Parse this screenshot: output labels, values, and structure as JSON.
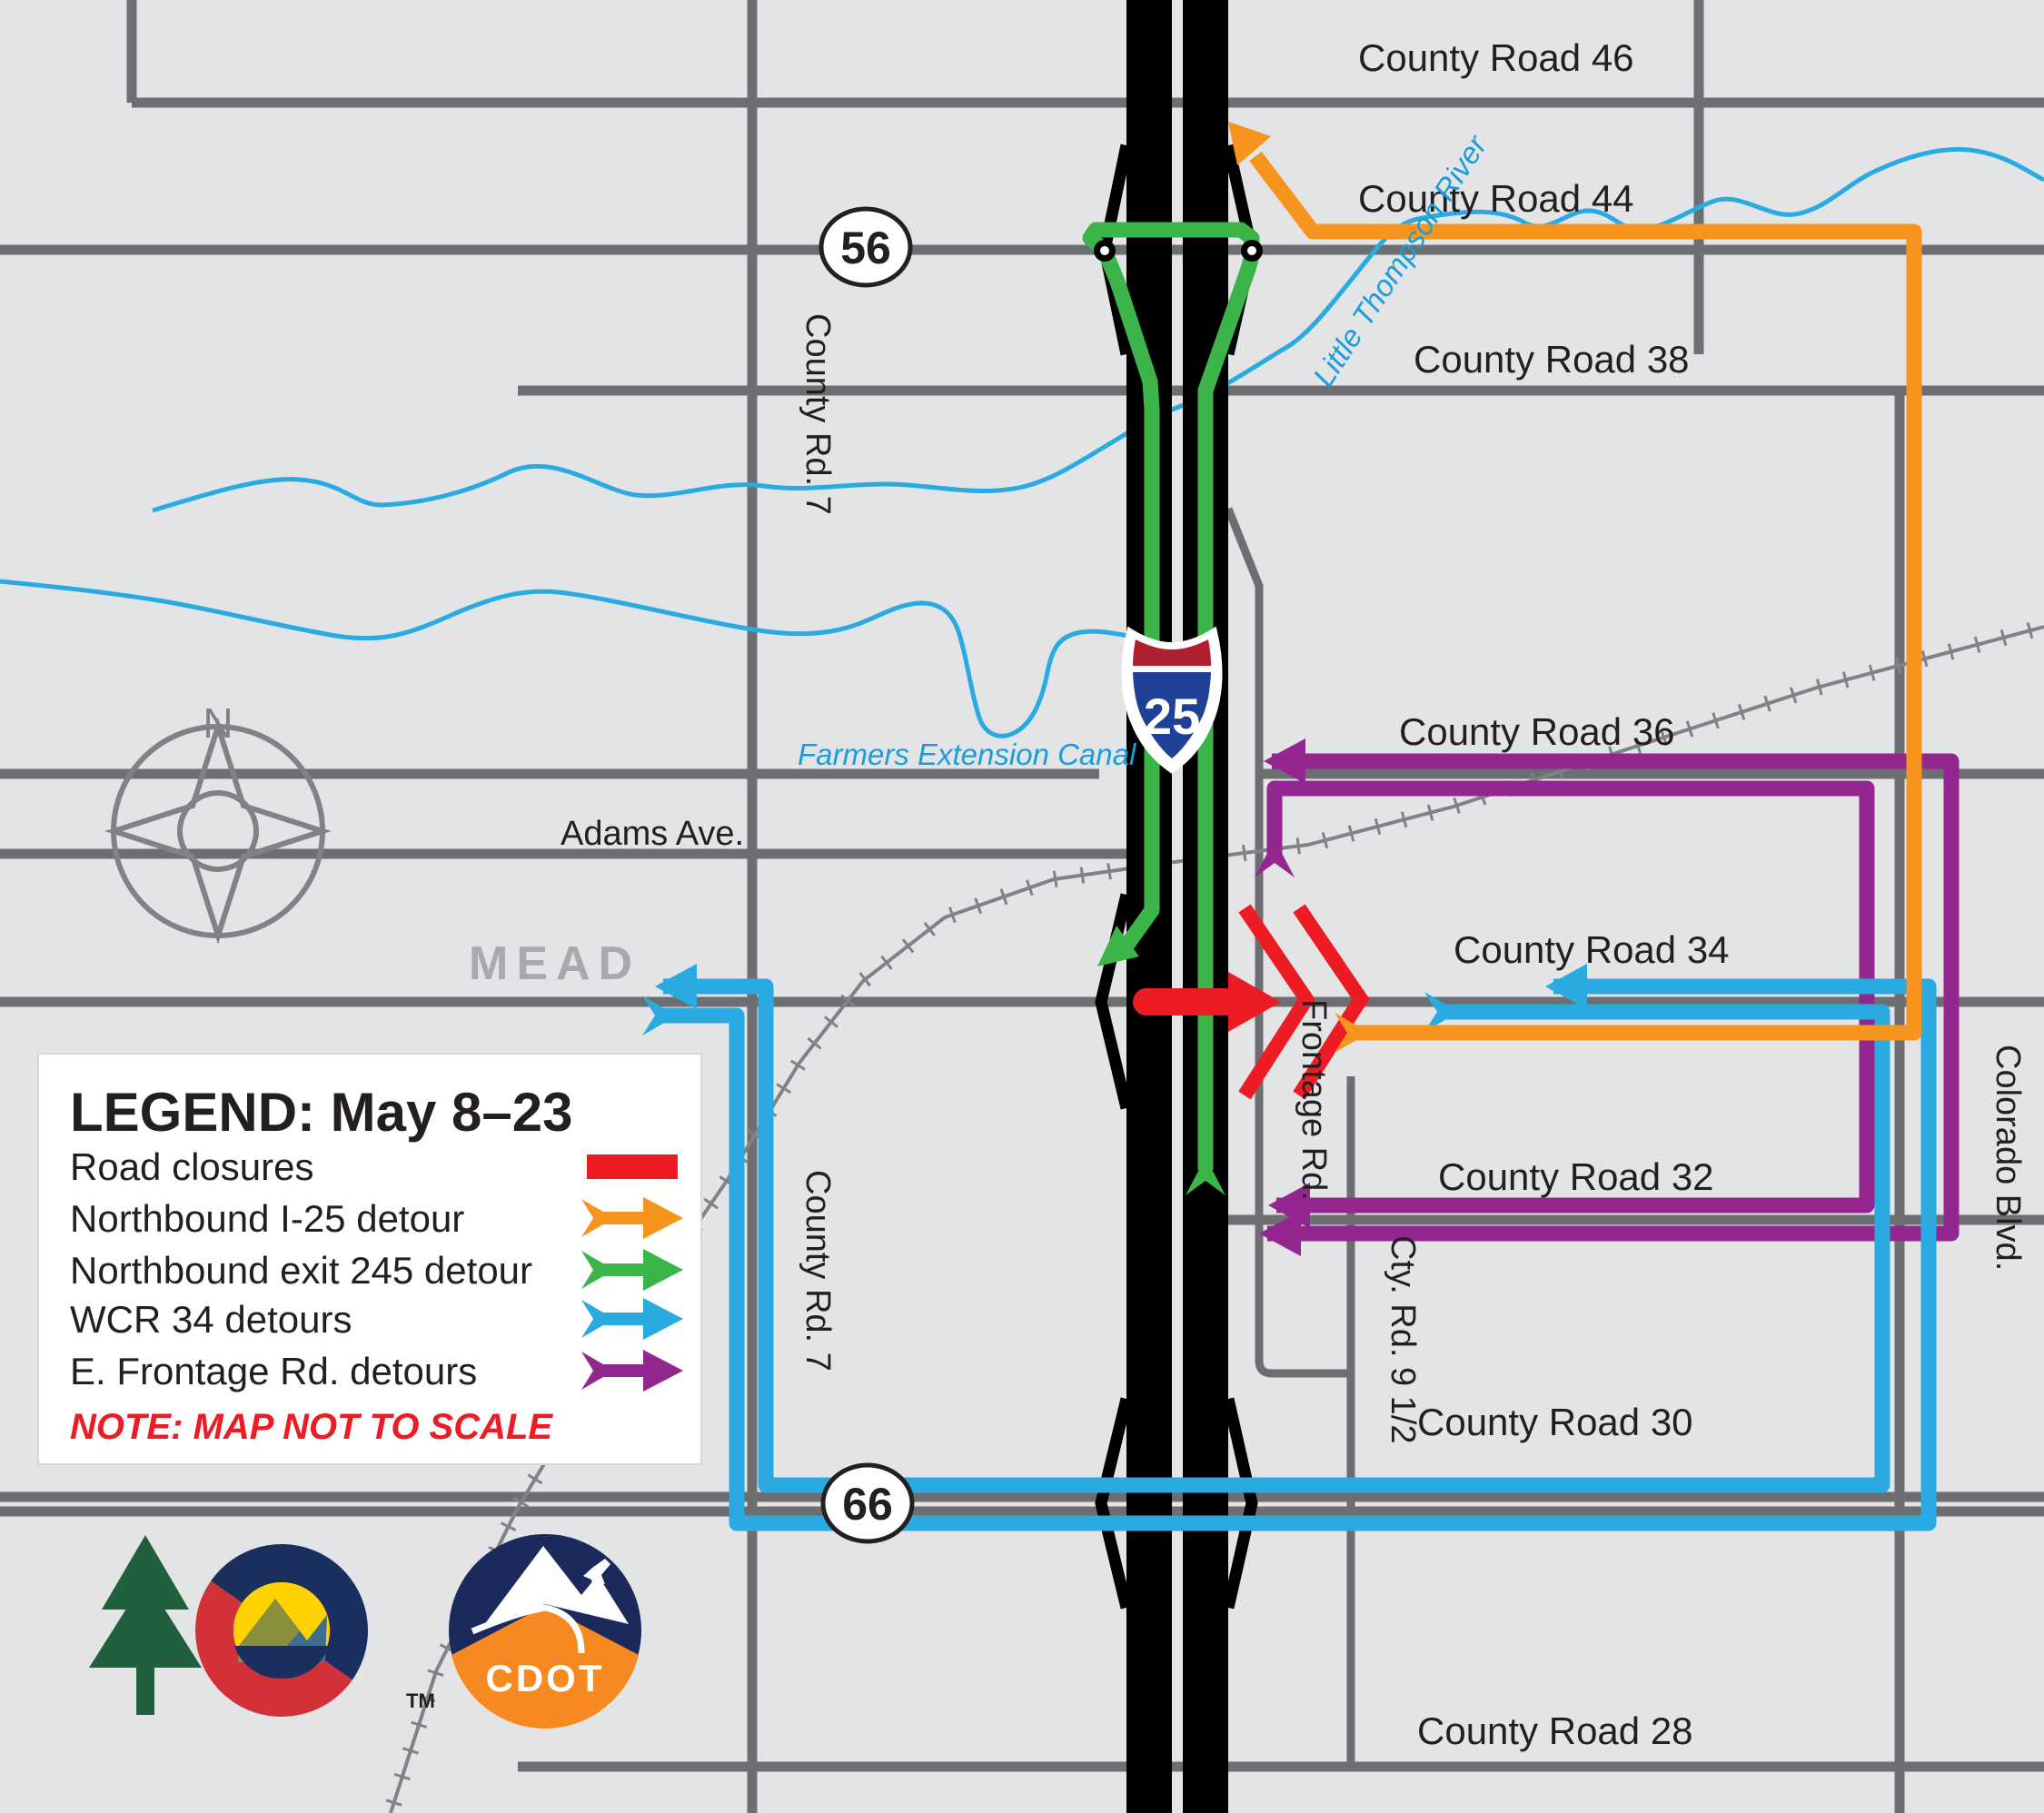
{
  "map": {
    "region_label": "MEAD",
    "compass_n": "N",
    "shields": {
      "i25": "25",
      "r56": "56",
      "r66": "66"
    },
    "county_roads": [
      {
        "text": "County Road 46"
      },
      {
        "text": "County Road 44"
      },
      {
        "text": "County Road 38"
      },
      {
        "text": "County Road 36"
      },
      {
        "text": "County Road 34"
      },
      {
        "text": "County Road 32"
      },
      {
        "text": "County Road 30"
      },
      {
        "text": "County Road 28"
      }
    ],
    "streets": {
      "county_rd_7_north": "County Rd. 7",
      "county_rd_7_south": "County Rd. 7",
      "adams_ave": "Adams Ave.",
      "frontage_rd": "Frontage Rd.",
      "cty_rd_9_half": "Cty. Rd. 9 1/2",
      "colorado_blvd": "Colorado Blvd."
    },
    "waterways": {
      "river": "Little Thompson River",
      "canal": "Farmers Extension Canal"
    }
  },
  "legend": {
    "title": "LEGEND:  May 8–23",
    "note": "NOTE: MAP NOT TO SCALE",
    "items": [
      {
        "label": "Road closures",
        "color": "#ed1c24",
        "symbol": "bar"
      },
      {
        "label": "Northbound I-25 detour",
        "color": "#f7941e",
        "symbol": "arrow"
      },
      {
        "label": "Northbound exit 245 detour",
        "color": "#3bb54a",
        "symbol": "arrow"
      },
      {
        "label": "WCR 34 detours",
        "color": "#29abe2",
        "symbol": "arrow"
      },
      {
        "label": "E. Frontage Rd. detours",
        "color": "#93278f",
        "symbol": "arrow"
      }
    ]
  },
  "logos": {
    "cdot": "CDOT",
    "tm": "TM"
  },
  "colors": {
    "background": "#e3e4e5",
    "road_gray": "#6d6e71",
    "rail_gray": "#808285",
    "water_blue": "#29abe2",
    "closure_red": "#ed1c24",
    "detour_orange": "#f7941e",
    "detour_green": "#3bb54a",
    "detour_blue": "#29abe2",
    "detour_purple": "#93278f",
    "mead_gray": "#a7a9ac",
    "text_black": "#231f20",
    "shield_red": "#b01f2e",
    "shield_blue": "#1e4096",
    "cdot_navy": "#1b2a5a",
    "cdot_orange": "#f6891f"
  }
}
